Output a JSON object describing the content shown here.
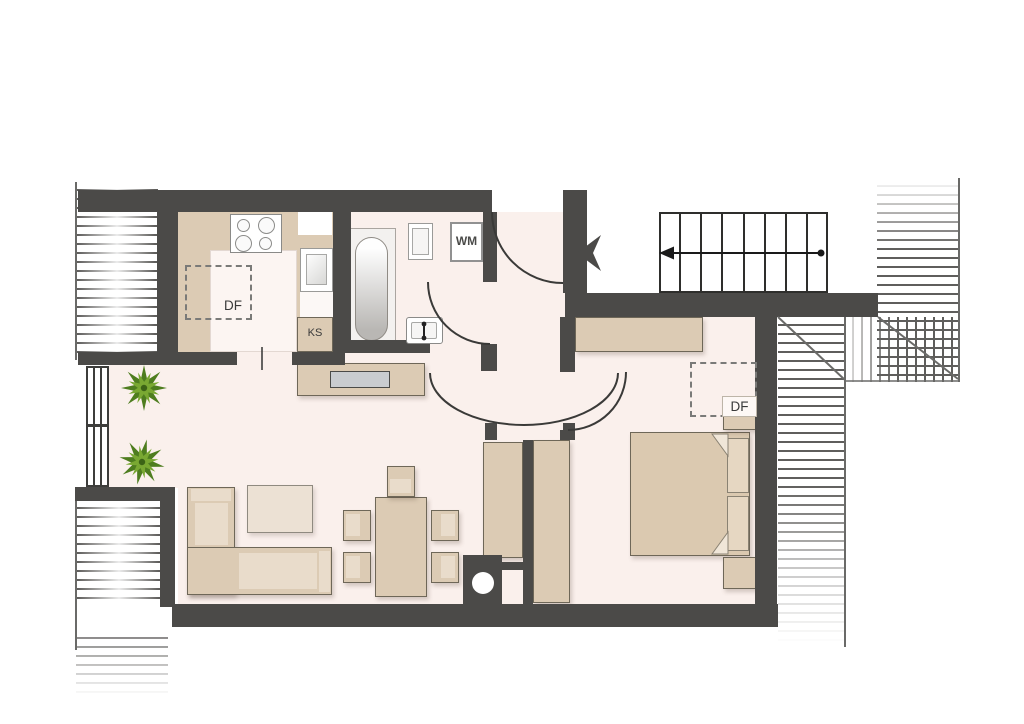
{
  "plan": {
    "type": "apartment-floor-plan",
    "labels": {
      "kitchen_skylight": "DF",
      "bedroom_skylight": "DF",
      "refrigerator": "KS",
      "washing_machine": "WM"
    },
    "symbols": {
      "entry_arrow_direction": "left",
      "stairs_arrow_direction": "left",
      "door_arcs": 4,
      "skylights": 2,
      "plants": 2
    },
    "colors": {
      "wall": "#4b4a48",
      "floor": "#faf0ec",
      "furniture": "#dccbb4",
      "furniture_light": "#e9dccb",
      "tv_screen": "#c9ccd0",
      "plant_dark": "#4e7d1f",
      "plant_light": "#79a832",
      "hatch_line": "#5f5e5c"
    }
  }
}
